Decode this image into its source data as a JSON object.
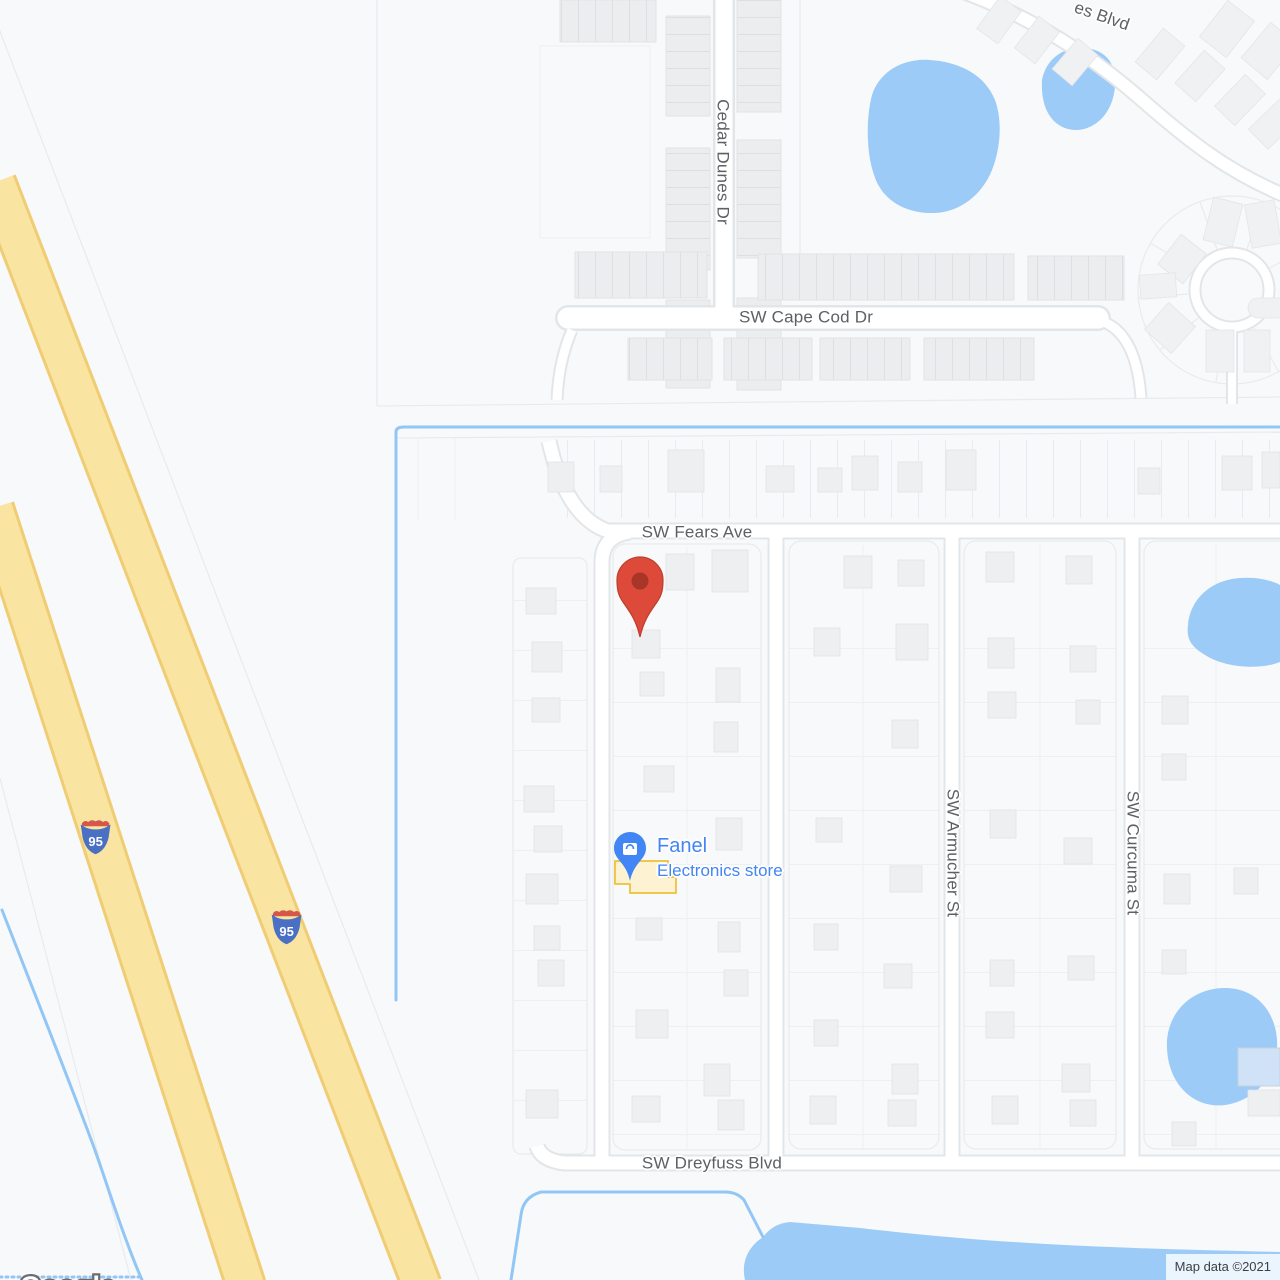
{
  "colors": {
    "land": "#f8f9fa",
    "water": "#9ccbf8",
    "water-line": "#92c6f5",
    "highway-fill": "#f9e5a1",
    "highway-edge": "#f0cd74",
    "road-fill": "#ffffff",
    "road-casing": "#e3e6e8",
    "road-label": "#5d6165",
    "pin-red": "#de4a3a",
    "pin-red-dark": "#a83527",
    "poi-blue": "#4285f4",
    "poi-building": "#eec84b",
    "shield-blue": "#4a70c4",
    "shield-red": "#d4574a"
  },
  "streets": {
    "cedar_dunes": "Cedar Dunes Dr",
    "cape_cod": "SW Cape Cod Dr",
    "fears": "SW Fears Ave",
    "armucher": "SW Armucher St",
    "curcuma": "SW Curcuma St",
    "dreyfuss": "SW Dreyfuss Blvd",
    "partial_blvd": "es Blvd"
  },
  "highway": {
    "shield": "95"
  },
  "poi": {
    "name": "Fanel",
    "category": "Electronics store"
  },
  "attribution": {
    "logo": "Google",
    "map_data": "Map data ©2021"
  }
}
